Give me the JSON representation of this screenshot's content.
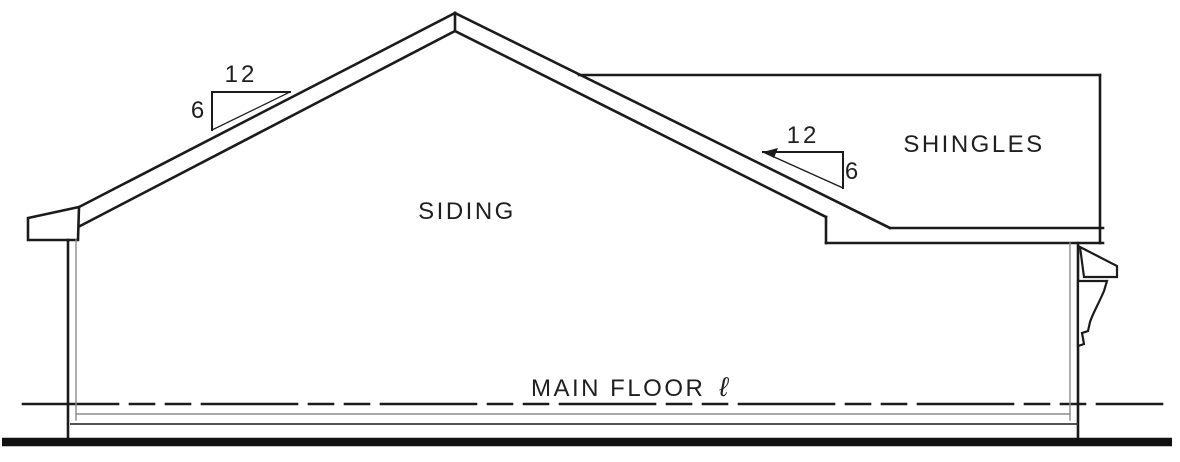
{
  "drawing": {
    "labels": {
      "siding": "SIDING",
      "shingles": "SHINGLES",
      "main_floor": "MAIN FLOOR",
      "level_symbol": "ℓ"
    },
    "pitch_left": {
      "run": "12",
      "rise": "6"
    },
    "pitch_right": {
      "run": "12",
      "rise": "6"
    },
    "colors": {
      "line": "#1b1b1b",
      "inner_line": "#8c8c8c",
      "foundation_line": "#3a3a3a",
      "ground": "#111111",
      "background": "#ffffff"
    }
  }
}
